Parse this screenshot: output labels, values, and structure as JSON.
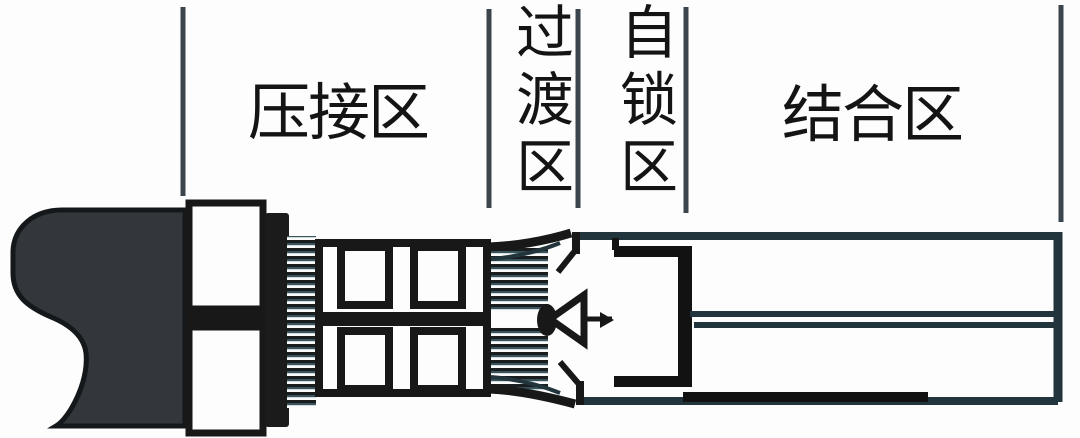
{
  "diagram": {
    "title": "连接器压接接触件分区示意图",
    "zones": [
      {
        "id": "crimp",
        "label": "压接区",
        "orientation": "horizontal"
      },
      {
        "id": "transition",
        "label": "过渡区",
        "orientation": "vertical"
      },
      {
        "id": "self-lock",
        "label": "自锁区",
        "orientation": "vertical"
      },
      {
        "id": "joint",
        "label": "结合区",
        "orientation": "horizontal"
      }
    ],
    "colors": {
      "background": "#fdfdfd",
      "ink": "#1c1c1c",
      "divider_line": "#3a454d",
      "wire_insulation_fill": "#33373c",
      "strand_teal": "#35565f"
    }
  }
}
